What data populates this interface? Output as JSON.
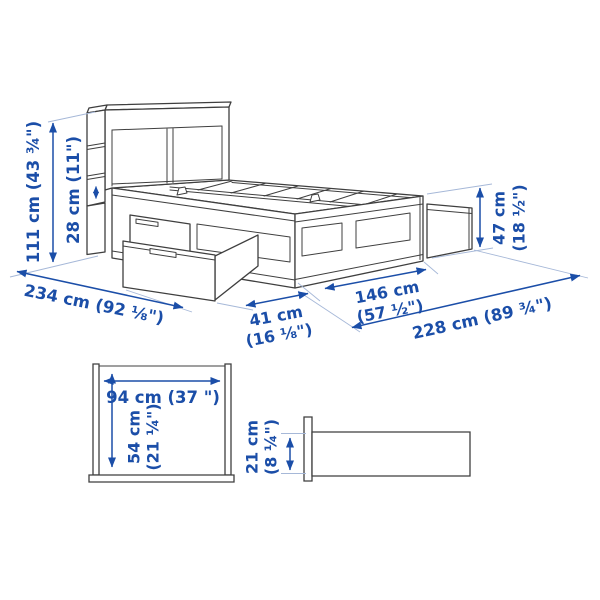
{
  "figure": {
    "title": "Storage bed with headboard — dimension diagram",
    "colors": {
      "dimension_blue": "#1b4ea8",
      "outline_gray": "#3f3f3f",
      "extension_line": "#a6b8d8",
      "background": "#ffffff"
    }
  },
  "dimensions": {
    "total_height": "111 cm (43 ¾\")",
    "headboard_storage": "28 cm (11\")",
    "total_length_diag": "234 cm (92 ⅛\")",
    "drawer_pullout": {
      "cm": "41 cm",
      "in": "(16 ⅛\")"
    },
    "bed_width": {
      "cm": "146 cm",
      "in": "(57 ½\")"
    },
    "frame_length": "228 cm (89 ¾\")",
    "footboard_height": {
      "cm": "47 cm",
      "in": "(18 ½\")"
    },
    "opening_width": "94 cm (37 \")",
    "opening_height": {
      "cm": "54 cm",
      "in": "(21 ¼\")"
    },
    "under_bed_clearance": {
      "cm": "21 cm",
      "in": "(8 ¼\")"
    }
  }
}
